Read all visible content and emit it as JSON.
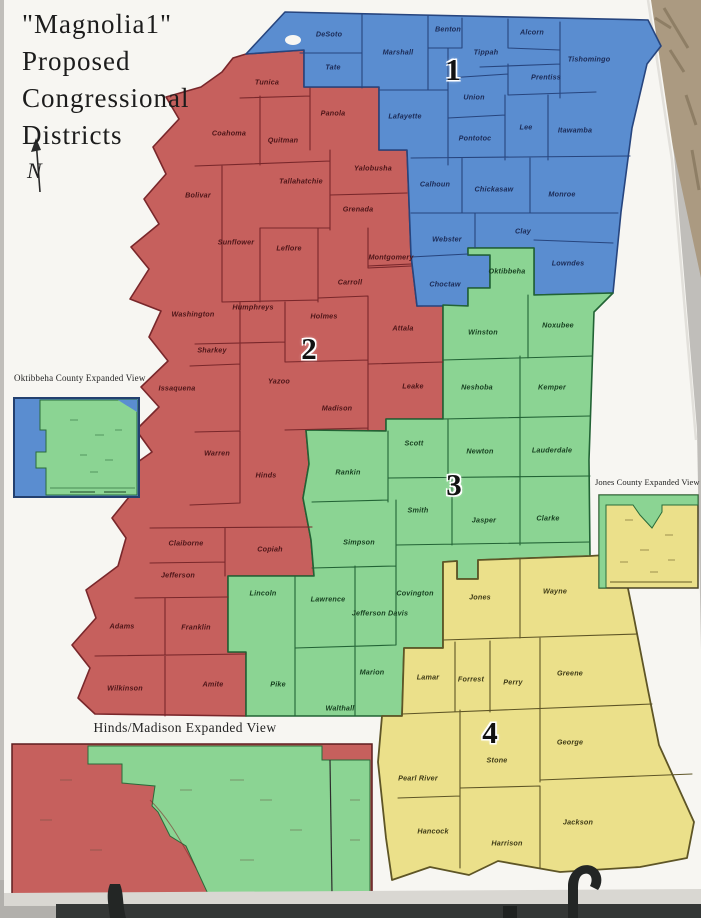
{
  "scene": {
    "poster_color": "#f7f6f2",
    "carpet_color": "#ab9a81",
    "wall_color": "#c6c4c0",
    "floor_color": "#b2b0ac",
    "easel_bar_color": "#343736"
  },
  "poster": {
    "title_lines": [
      "\"Magnolia1\"",
      "Proposed",
      "Congressional",
      "Districts"
    ],
    "compass_label": "N"
  },
  "map": {
    "districts": [
      {
        "number": "1",
        "color": "#5a8dd0",
        "border_color": "#27457e",
        "label_color": "#1b2a55",
        "number_x": 453,
        "number_y": 72
      },
      {
        "number": "2",
        "color": "#c6605d",
        "border_color": "#79272b",
        "label_color": "#4d1518",
        "number_x": 309,
        "number_y": 351
      },
      {
        "number": "3",
        "color": "#8bd493",
        "border_color": "#226335",
        "label_color": "#163f1f",
        "number_x": 454,
        "number_y": 487
      },
      {
        "number": "4",
        "color": "#ebe08a",
        "border_color": "#5e5526",
        "label_color": "#3e3a16",
        "number_x": 490,
        "number_y": 735
      }
    ],
    "counties": [
      {
        "name": "DeSoto",
        "district": 1,
        "x": 329,
        "y": 34
      },
      {
        "name": "Benton",
        "district": 1,
        "x": 448,
        "y": 29
      },
      {
        "name": "Alcorn",
        "district": 1,
        "x": 532,
        "y": 32
      },
      {
        "name": "Marshall",
        "district": 1,
        "x": 398,
        "y": 52
      },
      {
        "name": "Tippah",
        "district": 1,
        "x": 486,
        "y": 52
      },
      {
        "name": "Tishomingo",
        "district": 1,
        "x": 589,
        "y": 59
      },
      {
        "name": "Tate",
        "district": 1,
        "x": 333,
        "y": 67
      },
      {
        "name": "Prentiss",
        "district": 1,
        "x": 546,
        "y": 77
      },
      {
        "name": "Union",
        "district": 1,
        "x": 474,
        "y": 97
      },
      {
        "name": "Lafayette",
        "district": 1,
        "x": 405,
        "y": 116
      },
      {
        "name": "Lee",
        "district": 1,
        "x": 526,
        "y": 127
      },
      {
        "name": "Itawamba",
        "district": 1,
        "x": 575,
        "y": 130
      },
      {
        "name": "Pontotoc",
        "district": 1,
        "x": 475,
        "y": 138
      },
      {
        "name": "Calhoun",
        "district": 1,
        "x": 435,
        "y": 184
      },
      {
        "name": "Chickasaw",
        "district": 1,
        "x": 494,
        "y": 189
      },
      {
        "name": "Monroe",
        "district": 1,
        "x": 562,
        "y": 194
      },
      {
        "name": "Webster",
        "district": 1,
        "x": 447,
        "y": 239
      },
      {
        "name": "Clay",
        "district": 1,
        "x": 523,
        "y": 231
      },
      {
        "name": "Lowndes",
        "district": 1,
        "x": 568,
        "y": 263
      },
      {
        "name": "Choctaw",
        "district": 1,
        "x": 445,
        "y": 284
      },
      {
        "name": "Tunica",
        "district": 2,
        "x": 267,
        "y": 82
      },
      {
        "name": "Panola",
        "district": 2,
        "x": 333,
        "y": 113
      },
      {
        "name": "Coahoma",
        "district": 2,
        "x": 229,
        "y": 133
      },
      {
        "name": "Quitman",
        "district": 2,
        "x": 283,
        "y": 140
      },
      {
        "name": "Yalobusha",
        "district": 2,
        "x": 373,
        "y": 168
      },
      {
        "name": "Tallahatchie",
        "district": 2,
        "x": 301,
        "y": 181
      },
      {
        "name": "Bolivar",
        "district": 2,
        "x": 198,
        "y": 195
      },
      {
        "name": "Grenada",
        "district": 2,
        "x": 358,
        "y": 209
      },
      {
        "name": "Sunflower",
        "district": 2,
        "x": 236,
        "y": 242
      },
      {
        "name": "Leflore",
        "district": 2,
        "x": 289,
        "y": 248
      },
      {
        "name": "Montgomery",
        "district": 2,
        "x": 391,
        "y": 257
      },
      {
        "name": "Carroll",
        "district": 2,
        "x": 350,
        "y": 282
      },
      {
        "name": "Humphreys",
        "district": 2,
        "x": 253,
        "y": 307
      },
      {
        "name": "Washington",
        "district": 2,
        "x": 193,
        "y": 314
      },
      {
        "name": "Holmes",
        "district": 2,
        "x": 324,
        "y": 316
      },
      {
        "name": "Attala",
        "district": 2,
        "x": 403,
        "y": 328
      },
      {
        "name": "Sharkey",
        "district": 2,
        "x": 212,
        "y": 350
      },
      {
        "name": "Yazoo",
        "district": 2,
        "x": 279,
        "y": 381
      },
      {
        "name": "Issaquena",
        "district": 2,
        "x": 177,
        "y": 388
      },
      {
        "name": "Leake",
        "district": 2,
        "x": 413,
        "y": 386
      },
      {
        "name": "Madison",
        "district": 2,
        "x": 337,
        "y": 408
      },
      {
        "name": "Warren",
        "district": 2,
        "x": 217,
        "y": 453
      },
      {
        "name": "Hinds",
        "district": 2,
        "x": 266,
        "y": 475
      },
      {
        "name": "Claiborne",
        "district": 2,
        "x": 186,
        "y": 543
      },
      {
        "name": "Copiah",
        "district": 2,
        "x": 270,
        "y": 549
      },
      {
        "name": "Jefferson",
        "district": 2,
        "x": 178,
        "y": 575
      },
      {
        "name": "Adams",
        "district": 2,
        "x": 122,
        "y": 626
      },
      {
        "name": "Franklin",
        "district": 2,
        "x": 196,
        "y": 627
      },
      {
        "name": "Wilkinson",
        "district": 2,
        "x": 125,
        "y": 688
      },
      {
        "name": "Amite",
        "district": 2,
        "x": 213,
        "y": 684
      },
      {
        "name": "Oktibbeha",
        "district": 3,
        "x": 507,
        "y": 271
      },
      {
        "name": "Winston",
        "district": 3,
        "x": 483,
        "y": 332
      },
      {
        "name": "Noxubee",
        "district": 3,
        "x": 558,
        "y": 325
      },
      {
        "name": "Neshoba",
        "district": 3,
        "x": 477,
        "y": 387
      },
      {
        "name": "Kemper",
        "district": 3,
        "x": 552,
        "y": 387
      },
      {
        "name": "Scott",
        "district": 3,
        "x": 414,
        "y": 443
      },
      {
        "name": "Newton",
        "district": 3,
        "x": 480,
        "y": 451
      },
      {
        "name": "Lauderdale",
        "district": 3,
        "x": 552,
        "y": 450
      },
      {
        "name": "Rankin",
        "district": 3,
        "x": 348,
        "y": 472
      },
      {
        "name": "Smith",
        "district": 3,
        "x": 418,
        "y": 510
      },
      {
        "name": "Jasper",
        "district": 3,
        "x": 484,
        "y": 520
      },
      {
        "name": "Clarke",
        "district": 3,
        "x": 548,
        "y": 518
      },
      {
        "name": "Simpson",
        "district": 3,
        "x": 359,
        "y": 542
      },
      {
        "name": "Lincoln",
        "district": 3,
        "x": 263,
        "y": 593
      },
      {
        "name": "Lawrence",
        "district": 3,
        "x": 328,
        "y": 599
      },
      {
        "name": "Covington",
        "district": 3,
        "x": 415,
        "y": 593
      },
      {
        "name": "Jefferson Davis",
        "district": 3,
        "x": 380,
        "y": 613
      },
      {
        "name": "Marion",
        "district": 3,
        "x": 372,
        "y": 672
      },
      {
        "name": "Pike",
        "district": 3,
        "x": 278,
        "y": 684
      },
      {
        "name": "Walthall",
        "district": 3,
        "x": 340,
        "y": 708
      },
      {
        "name": "Wayne",
        "district": 4,
        "x": 555,
        "y": 591
      },
      {
        "name": "Jones",
        "district": 4,
        "x": 480,
        "y": 597
      },
      {
        "name": "Greene",
        "district": 4,
        "x": 570,
        "y": 673
      },
      {
        "name": "Lamar",
        "district": 4,
        "x": 428,
        "y": 677
      },
      {
        "name": "Forrest",
        "district": 4,
        "x": 471,
        "y": 679
      },
      {
        "name": "Perry",
        "district": 4,
        "x": 513,
        "y": 682
      },
      {
        "name": "George",
        "district": 4,
        "x": 570,
        "y": 742
      },
      {
        "name": "Stone",
        "district": 4,
        "x": 497,
        "y": 760
      },
      {
        "name": "Pearl River",
        "district": 4,
        "x": 418,
        "y": 778
      },
      {
        "name": "Jackson",
        "district": 4,
        "x": 578,
        "y": 822
      },
      {
        "name": "Hancock",
        "district": 4,
        "x": 433,
        "y": 831
      },
      {
        "name": "Harrison",
        "district": 4,
        "x": 507,
        "y": 843
      }
    ]
  },
  "insets": {
    "oktibbeha": {
      "caption": "Oktibbeha County Expanded View"
    },
    "jones": {
      "caption": "Jones County Expanded View"
    },
    "hinds_madison": {
      "caption": "Hinds/Madison Expanded View"
    }
  }
}
